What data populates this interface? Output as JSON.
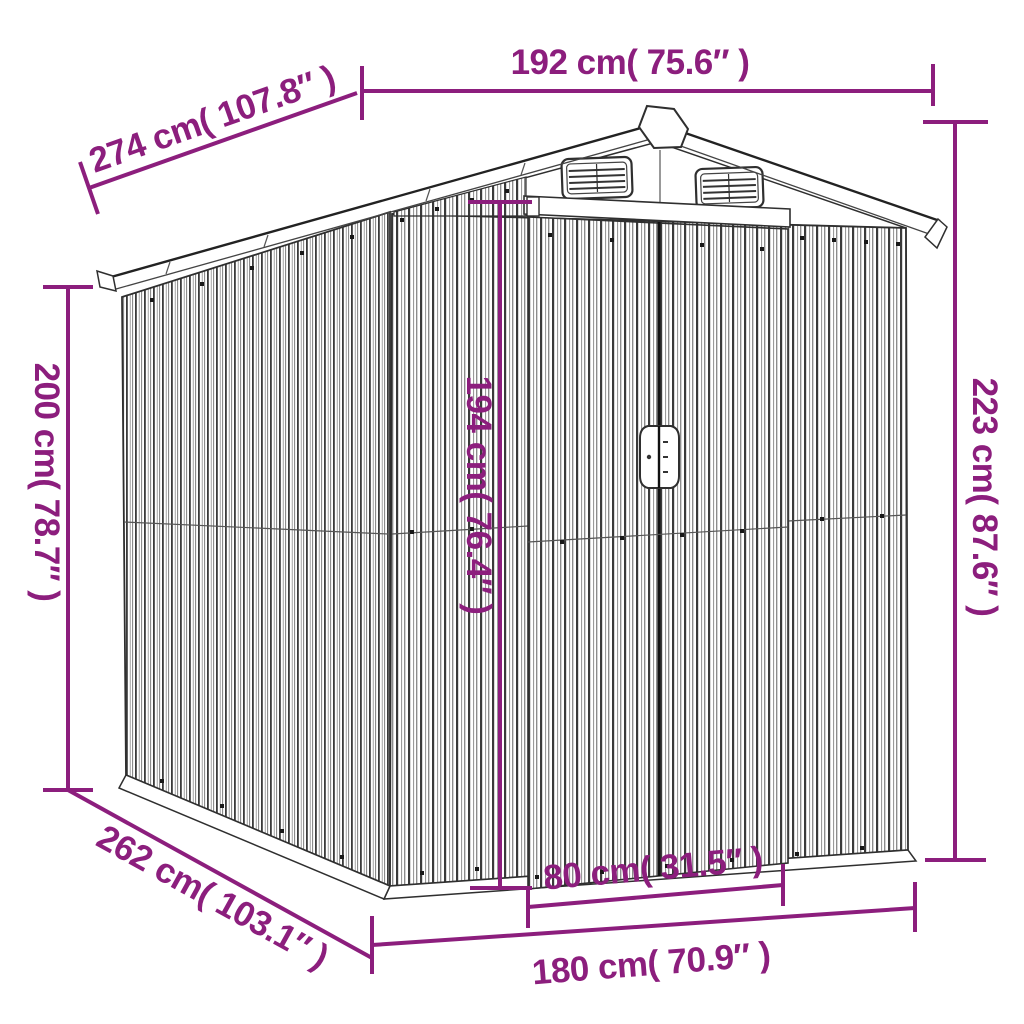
{
  "diagram": {
    "subject": "garden-shed-dimension-drawing",
    "colors": {
      "dimension_accent": "#8C1E7D",
      "line_art": "#2f2f2f",
      "background": "#ffffff"
    },
    "labels": {
      "overall_width_top": "192 cm( 75.6″ )",
      "roof_depth_top": "274 cm( 107.8″ )",
      "rear_wall_height": "200 cm( 78.7″ )",
      "front_wall_height": "223 cm( 87.6″ )",
      "door_height": "194 cm( 76.4″ )",
      "door_width": "80 cm( 31.5″ )",
      "base_depth": "262 cm( 103.1″ )",
      "base_width": "180 cm( 70.9″ )"
    }
  }
}
